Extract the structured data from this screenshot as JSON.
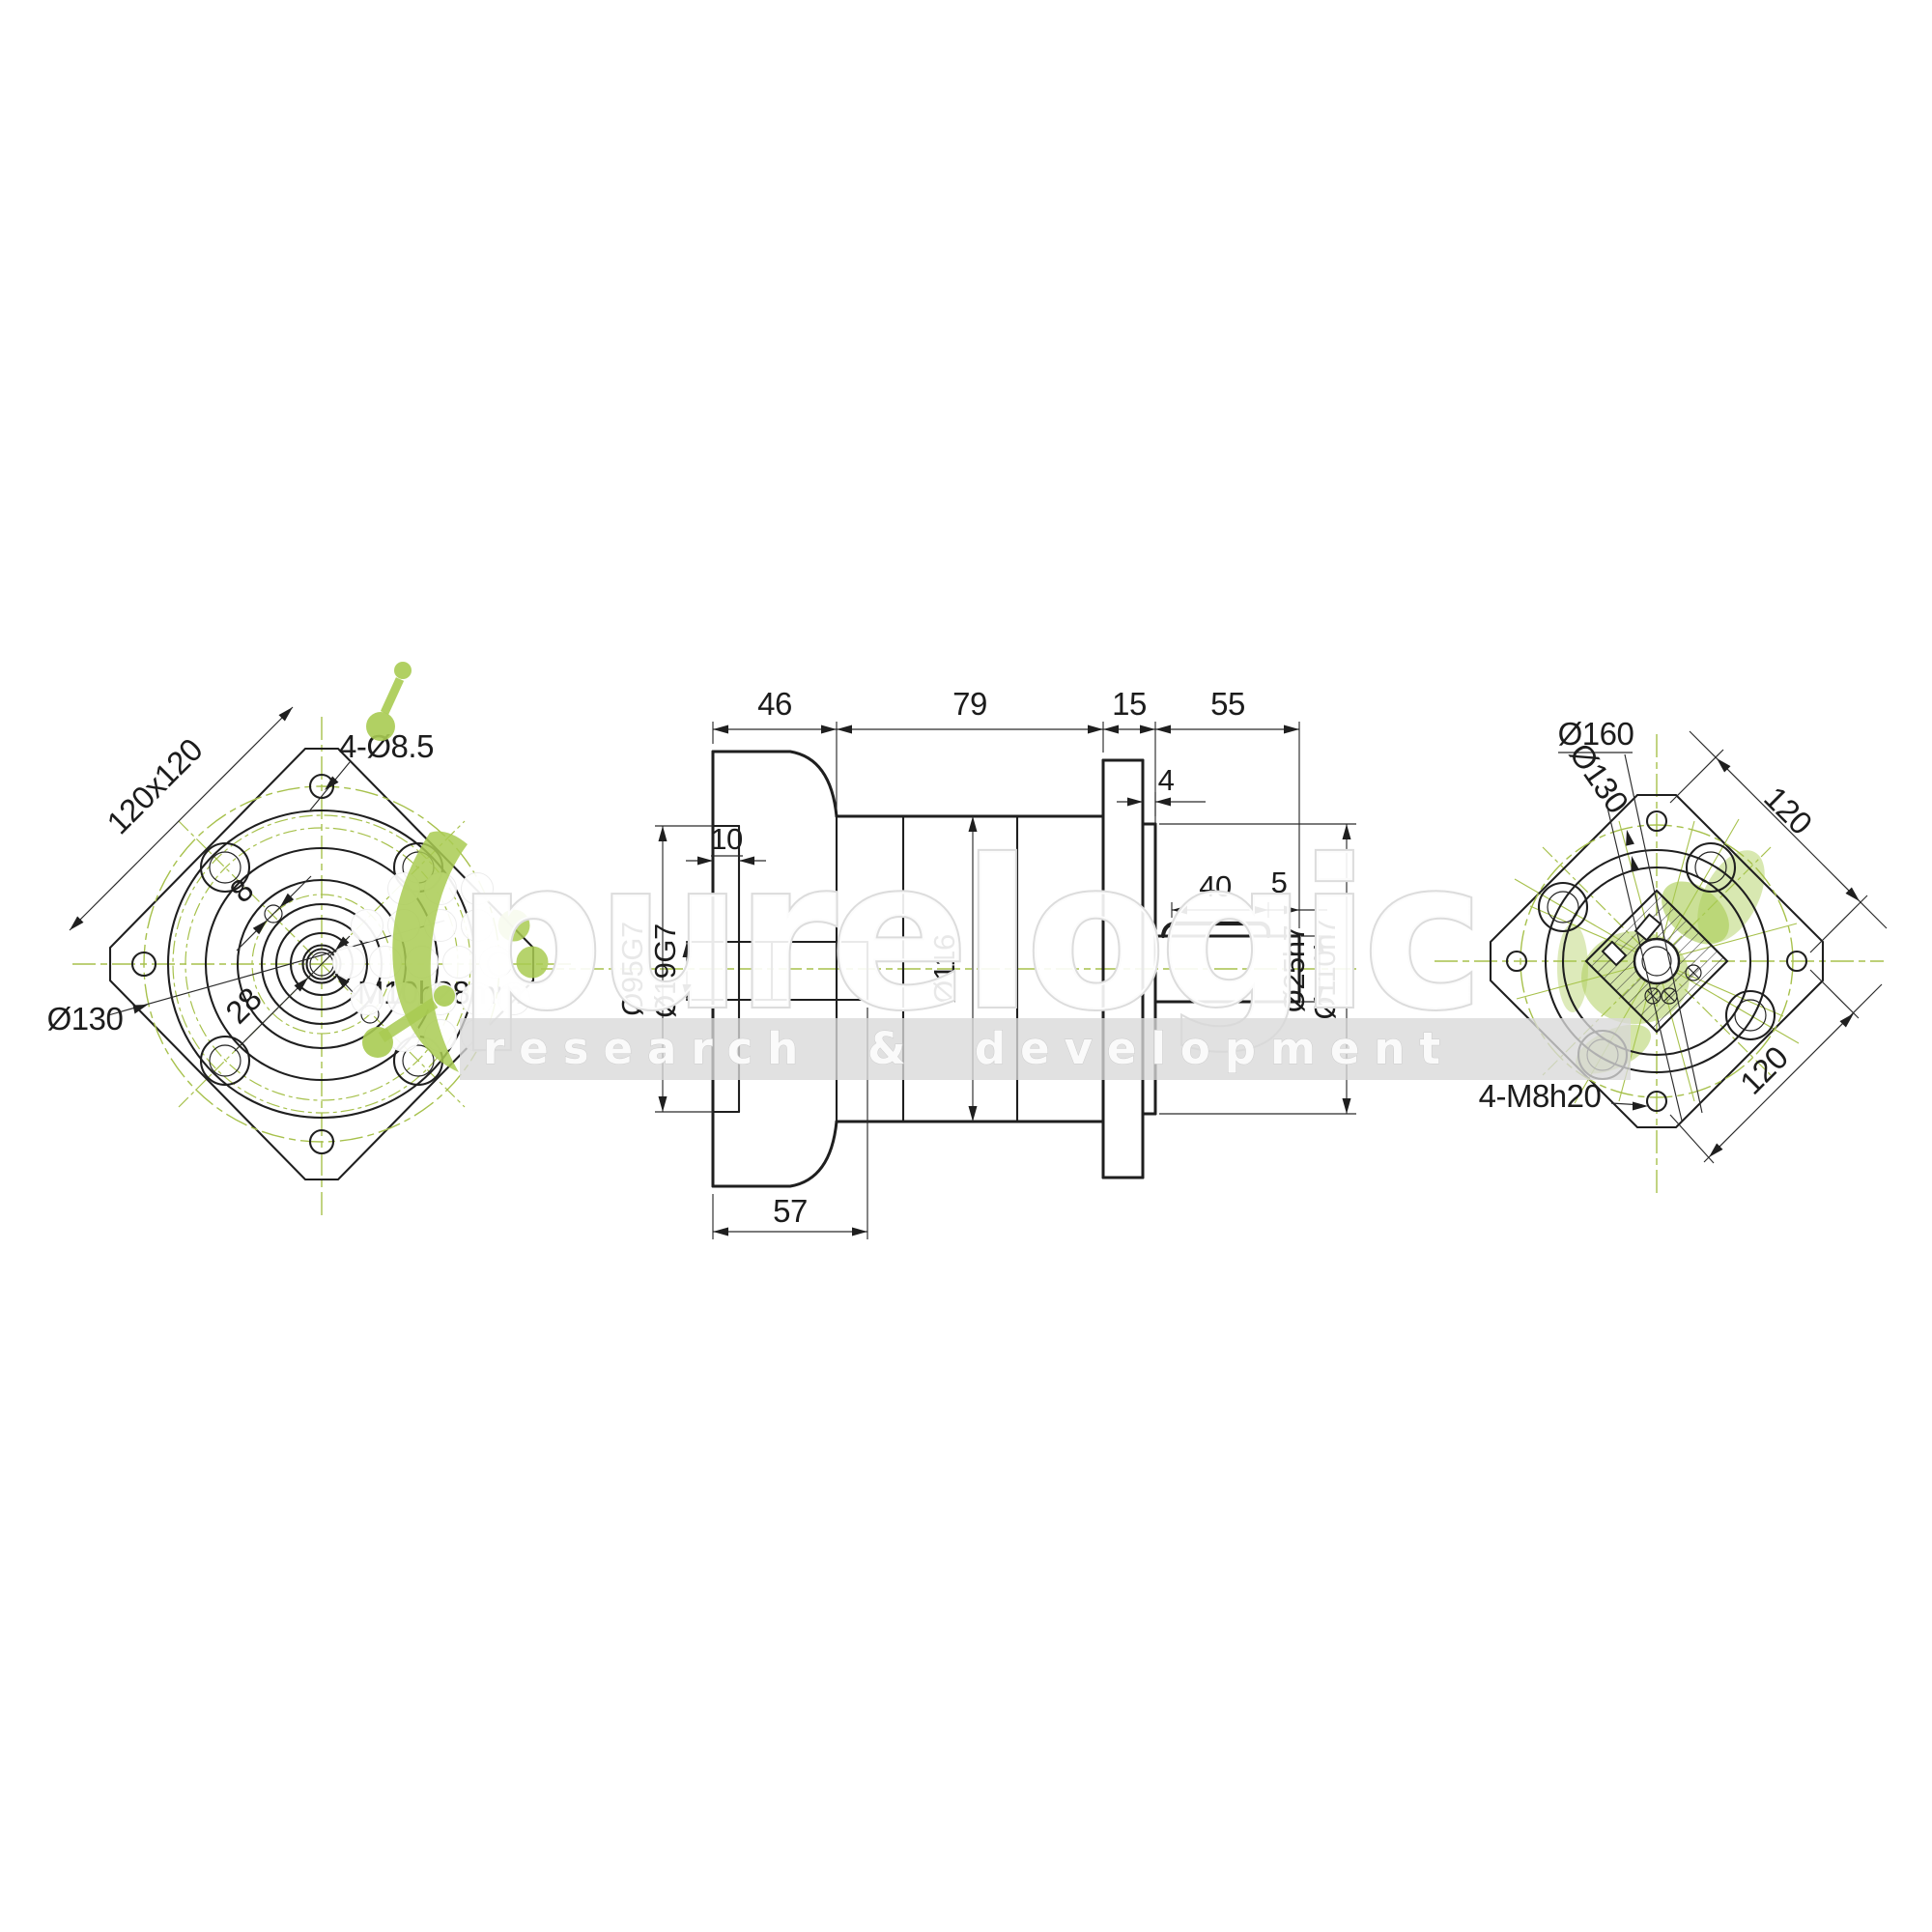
{
  "drawing": {
    "background": "#ffffff",
    "line_color": "#1f1f1f",
    "centerline_color": "#a7c14c",
    "views": {
      "front": {
        "labels": {
          "corner_holes": "4-Ø8.5",
          "square": "120x120",
          "bolt_circle": "Ø130",
          "center_thread": "M10h28mm",
          "hub_pitch": "28",
          "pin_hole": "8"
        }
      },
      "side": {
        "labels": {
          "input_len": "46",
          "body_len": "79",
          "flange_len": "15",
          "shaft_len": "55",
          "recess_depth": "10",
          "spigot_len": "4",
          "key_len": "40",
          "key_offset": "5",
          "input_total": "57",
          "input_bore": "Ø95G7",
          "shaft_bore": "Ø19G7",
          "body_dia": "Ø116",
          "out_shaft_dia": "Ø25h7",
          "spigot_dia": "Ø110h7"
        }
      },
      "rear": {
        "labels": {
          "outer_circle": "Ø160",
          "bolt_circle": "Ø130",
          "hole_pitch_a": "120",
          "hole_pitch_b": "120",
          "tapped_holes": "4-M8h20"
        }
      }
    }
  },
  "watermark": {
    "brand": "purelogic",
    "tagline": "research & development",
    "green": "#a9cb52",
    "gray": "#d9d9d9"
  }
}
